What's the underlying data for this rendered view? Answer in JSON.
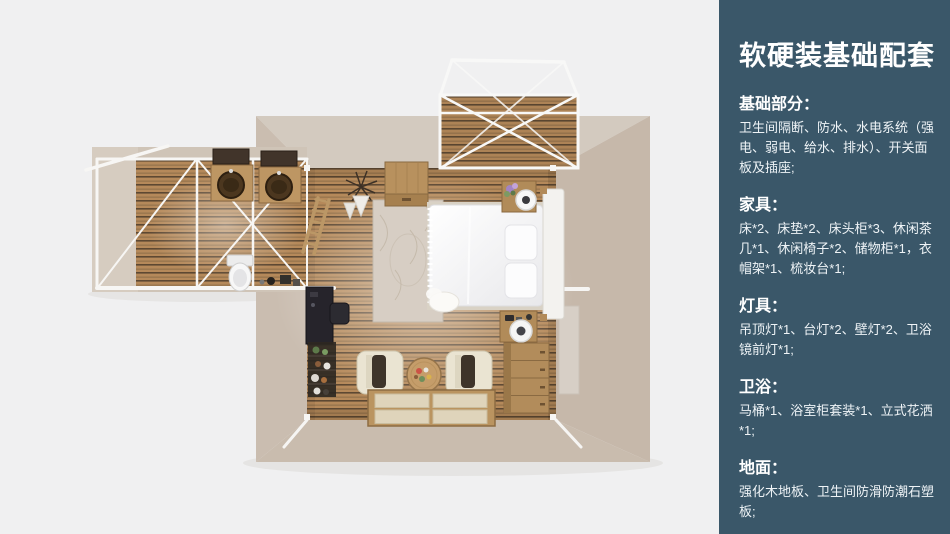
{
  "colors": {
    "panel_bg": "#3a5769",
    "canvas_bg": "#f0f0f1",
    "panel_text": "#ffffff",
    "wood_floor": "#b5895a",
    "wall_beige": "#cfc4b7"
  },
  "panel": {
    "title": "软硬装基础配套",
    "sections": [
      {
        "heading": "基础部分：",
        "body": "卫生间隔断、防水、水电系统（强电、弱电、给水、排水）、开关面板及插座;"
      },
      {
        "heading": "家具：",
        "body": "床*2、床垫*2、床头柜*3、休闲茶几*1、休闲椅子*2、储物柜*1，衣帽架*1、梳妆台*1;"
      },
      {
        "heading": "灯具：",
        "body": "吊顶灯*1、台灯*2、壁灯*2、卫浴镜前灯*1;"
      },
      {
        "heading": "卫浴：",
        "body": "马桶*1、浴室柜套装*1、立式花洒*1;"
      },
      {
        "heading": "地面：",
        "body": "强化木地板、卫生间防滑防潮石塑板;"
      }
    ]
  }
}
